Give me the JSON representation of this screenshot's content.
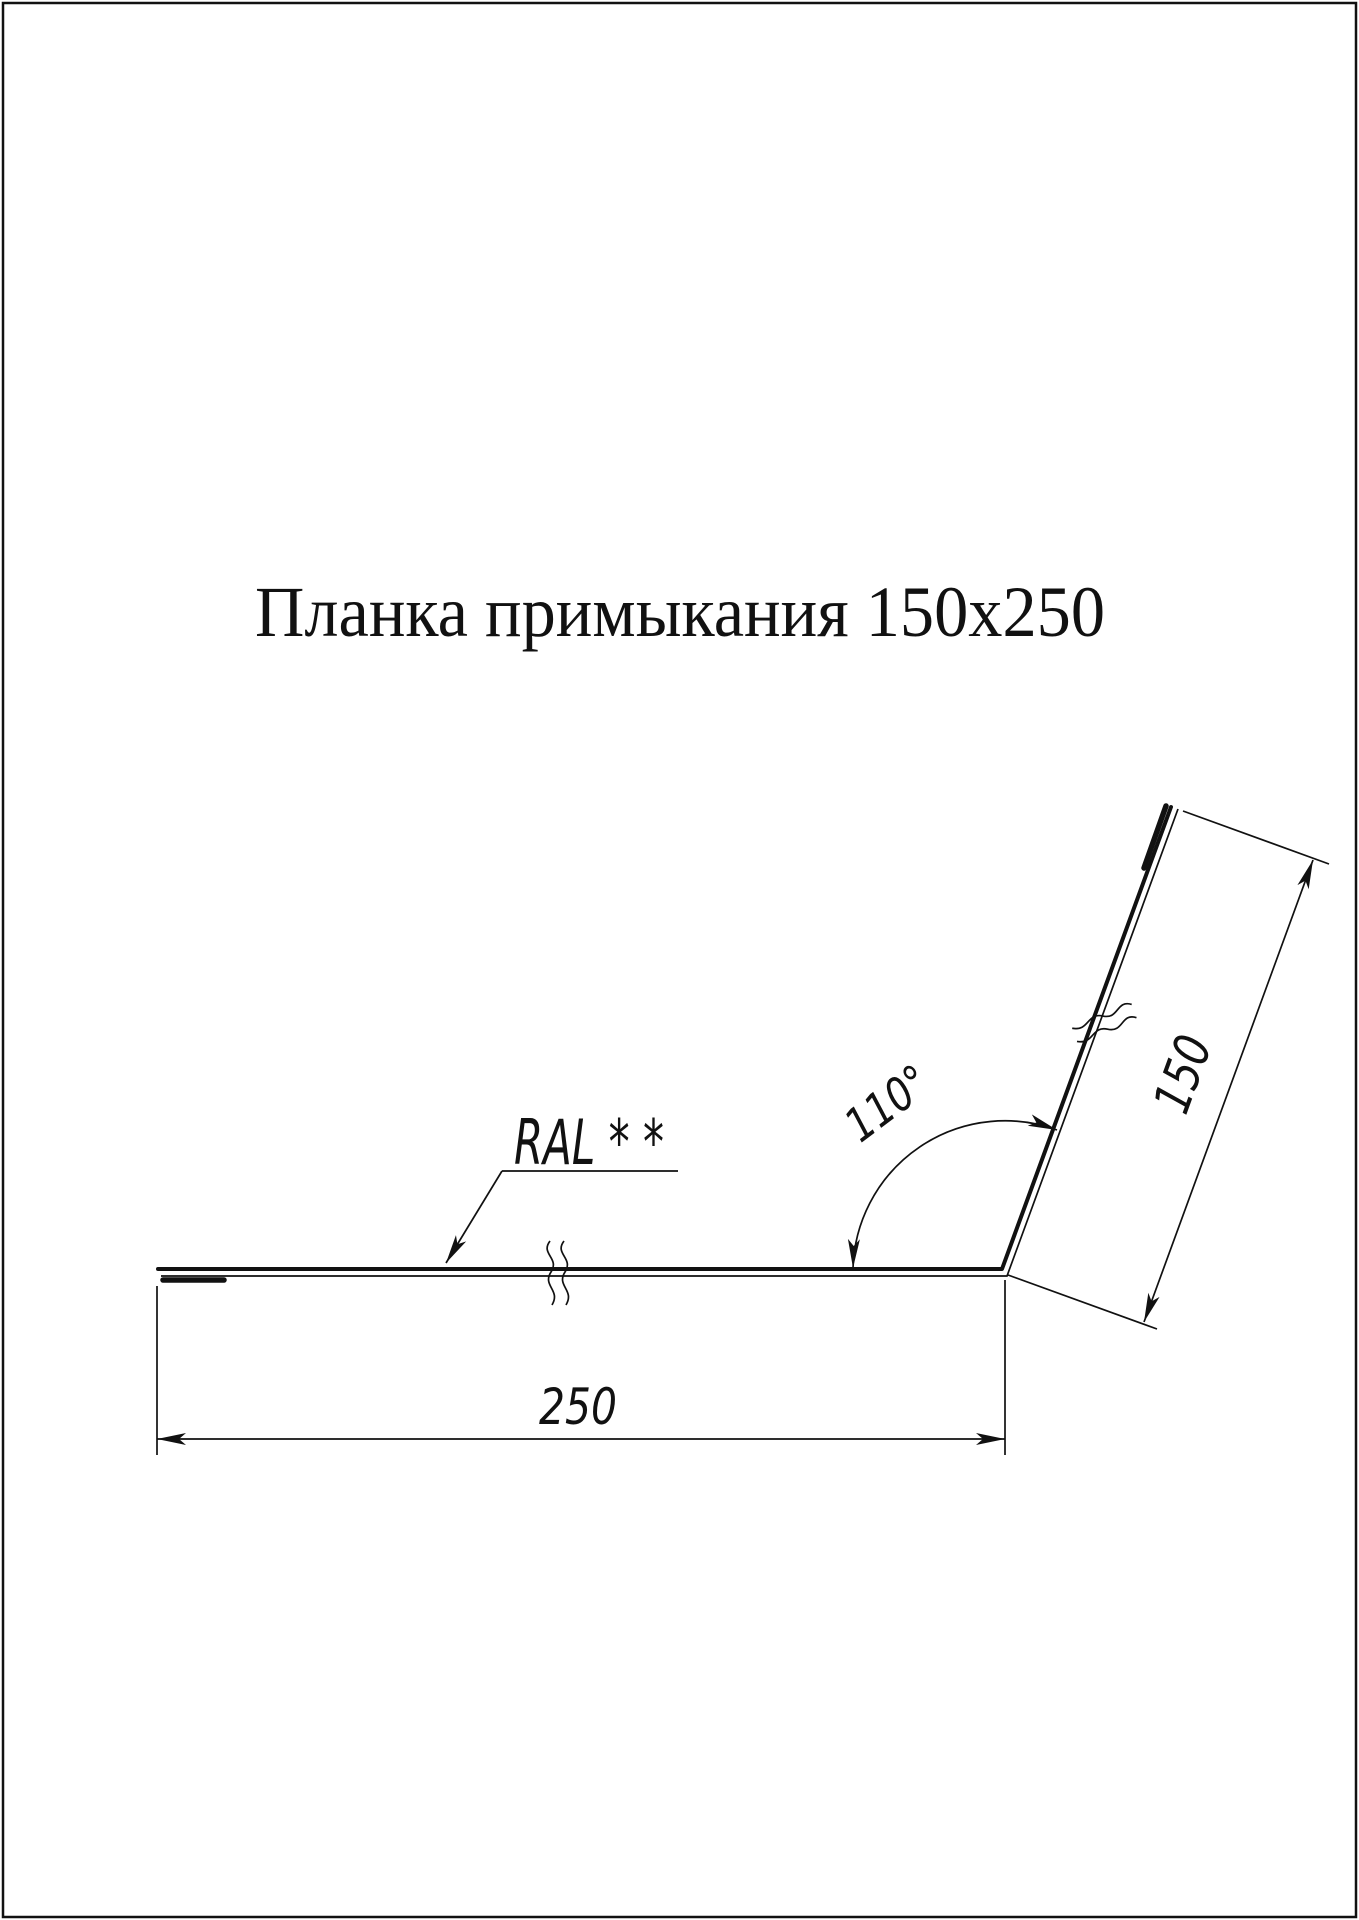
{
  "title": "Планка примыкания 150x250",
  "annotations": {
    "color_label": "RAL * *",
    "angle_label": "110°",
    "flange_length_label": "150",
    "base_length_label": "250"
  },
  "colors": {
    "ink": "#111111",
    "paper": "#ffffff"
  }
}
